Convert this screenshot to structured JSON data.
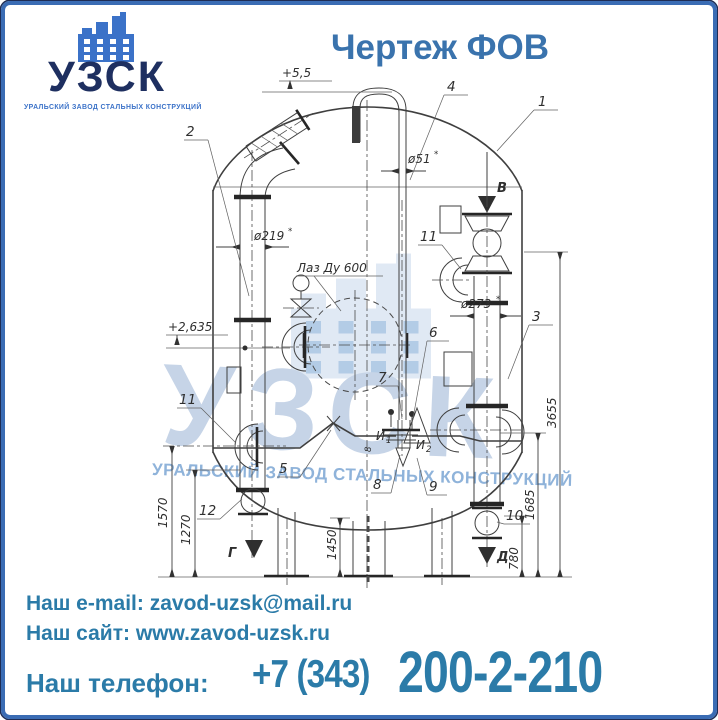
{
  "page": {
    "background": "#ffffff",
    "frame_color": "#3a6cb4",
    "frame_outline_color": "#1e2d55"
  },
  "logo": {
    "name": "УЗСК",
    "subtitle": "УРАЛЬСКИЙ ЗАВОД СТАЛЬНЫХ КОНСТРУКЦИЙ",
    "name_color": "#1e2f60",
    "icon": "factory-icon",
    "icon_color": "#3b72c8"
  },
  "title": {
    "text": "Чертеж ФОВ",
    "color": "#3a73ad"
  },
  "watermark": {
    "text": "УЗСК",
    "subtitle": "УРАЛЬСКИЙ ЗАВОД СТАЛЬНЫХ КОНСТРУКЦИЙ",
    "text_color": "#c6d4e7",
    "subtitle_color": "#8fb3da",
    "icon": "factory-icon"
  },
  "drawing": {
    "levels": {
      "top": "+5,5",
      "mid": "+2,635"
    },
    "diameters": {
      "vent": "ø51",
      "left_pipe": "ø219",
      "right_pipe": "ø273",
      "star": "*"
    },
    "manhole_label": "Лаз Ду 600",
    "dims": {
      "h_total": "3655",
      "h_1685": "1685",
      "h_780": "780",
      "h_1450": "1450",
      "h_1570": "1570",
      "h_1270": "1270",
      "w_8": "8"
    },
    "flows": {
      "b": "В",
      "g": "Г",
      "d": "Д"
    },
    "taps": {
      "i": "И",
      "i1_sub": "1",
      "i2_sub": "2"
    },
    "parts": {
      "p1": "1",
      "p2": "2",
      "p3": "3",
      "p4": "4",
      "p5": "5",
      "p6": "6",
      "p7": "7",
      "p8": "8",
      "p9": "9",
      "p10": "10",
      "p11_left": "11",
      "p11_right": "11",
      "p12": "12"
    }
  },
  "footer": {
    "email_label": "Наш e-mail:",
    "email_value": "zavod-uzsk@mail.ru",
    "site_label": "Наш сайт:",
    "site_value": "www.zavod-uzsk.ru",
    "phone_label": "Наш телефон:",
    "phone_prefix": "+7 (343)",
    "phone_number": "200-2-210",
    "text_color": "#2b7ba8"
  }
}
